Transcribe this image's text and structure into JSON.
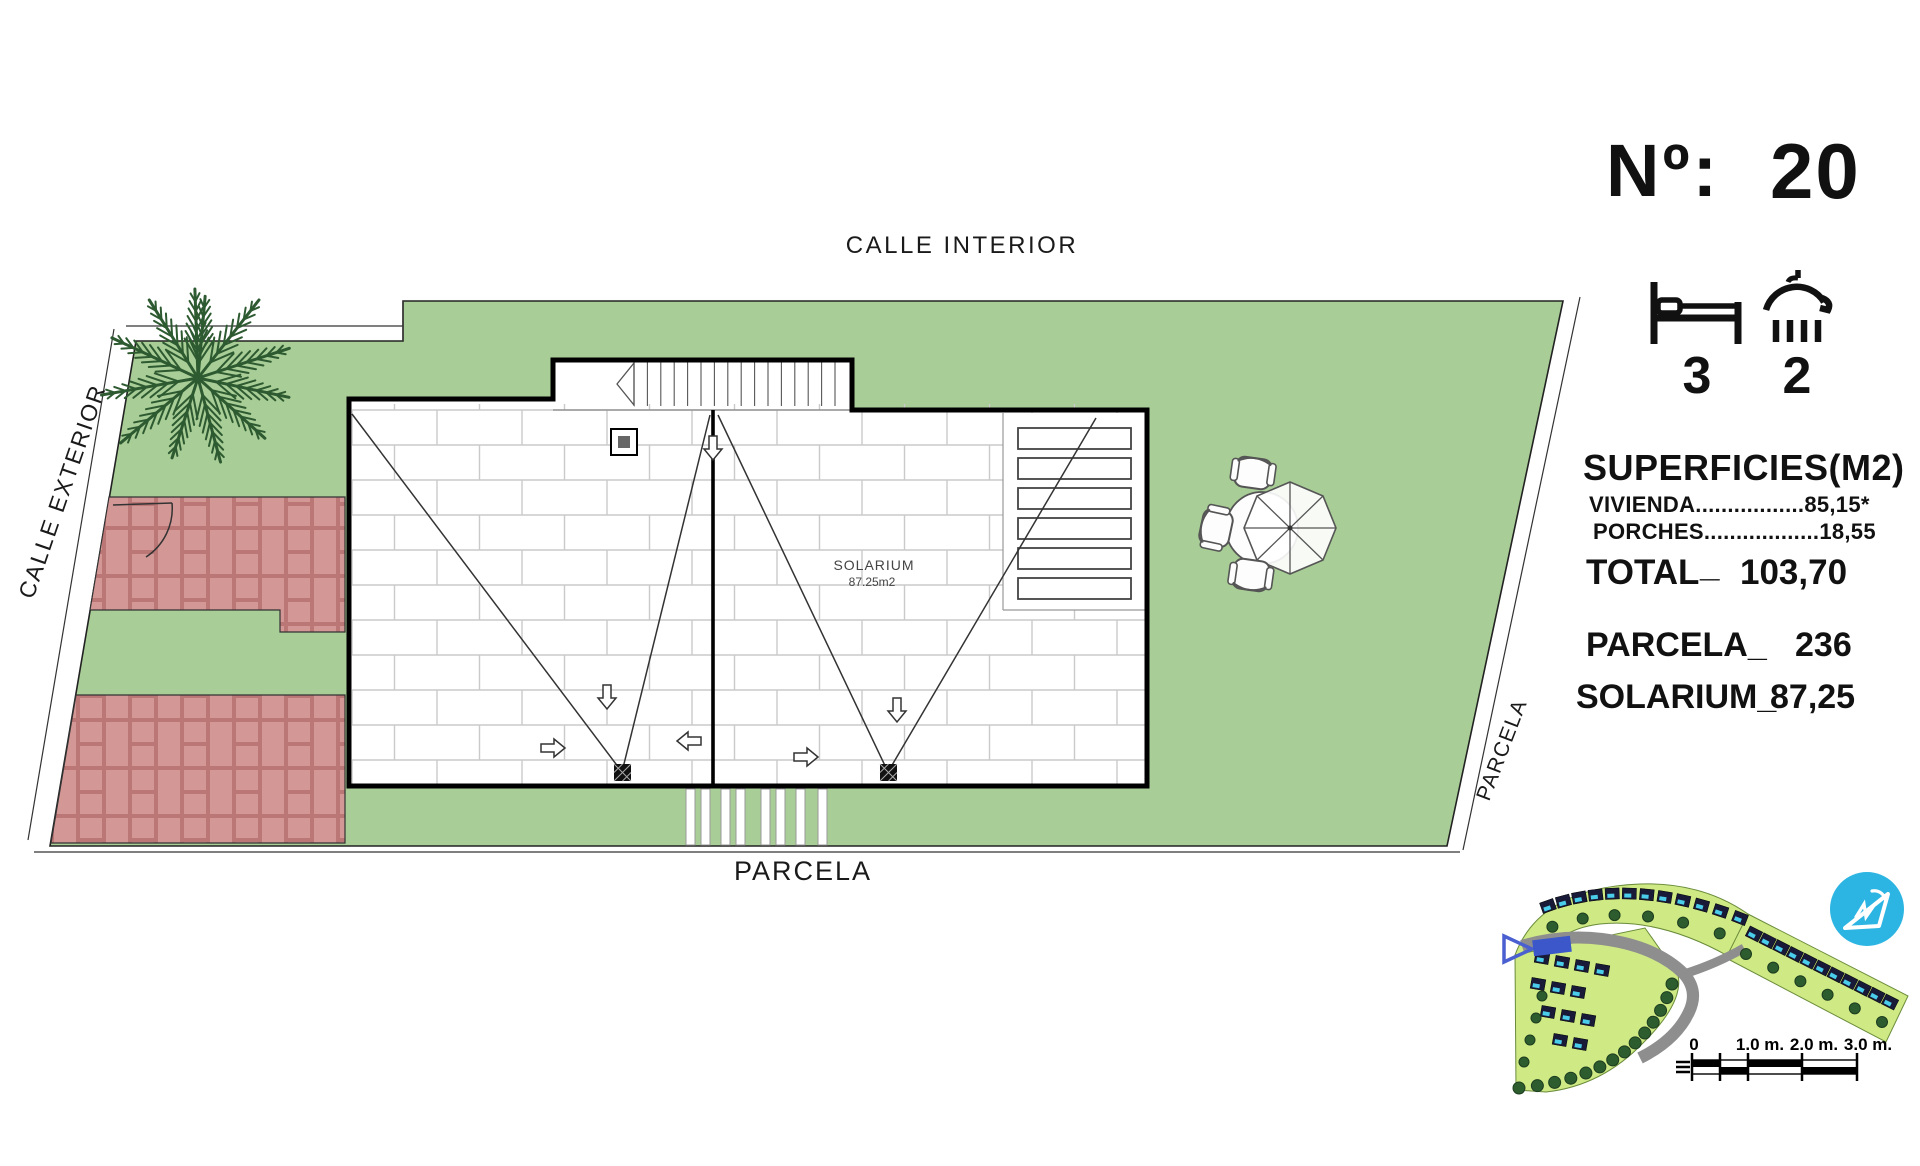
{
  "panel": {
    "no_label": "Nº:",
    "no_value": "20",
    "beds": "3",
    "baths": "2",
    "superficies_title": "SUPERFICIES(M2)",
    "vivienda": "VIVIENDA.................85,15*",
    "porches": "PORCHES..................18,55",
    "total_label": "TOTAL",
    "total_sep": "_",
    "total_value": "103,70",
    "parcela_label": "PARCELA_",
    "parcela_value": "236",
    "solarium_label": "SOLARIUM_",
    "solarium_value": "87,25"
  },
  "plan": {
    "calle_interior": "CALLE INTERIOR",
    "calle_exterior": "CALLE EXTERIOR",
    "parcela_bottom": "PARCELA",
    "parcela_right": "PARCELA",
    "solarium_name": "SOLARIUM",
    "solarium_area": "87.25m2"
  },
  "scale_bar": {
    "labels": [
      "0",
      "1.0 m.",
      "2.0 m.",
      "3.0 m."
    ]
  },
  "colors": {
    "lawn": "#a8cd96",
    "brick": "#d39795",
    "brick_mortar": "#bb7676",
    "tile_line": "#cacaca",
    "minimap_green": "#cfe985",
    "pool": "#49cdea",
    "house": "#181a38",
    "logo": "#2cb5e2",
    "highlight_lot": "#3c57c9"
  }
}
